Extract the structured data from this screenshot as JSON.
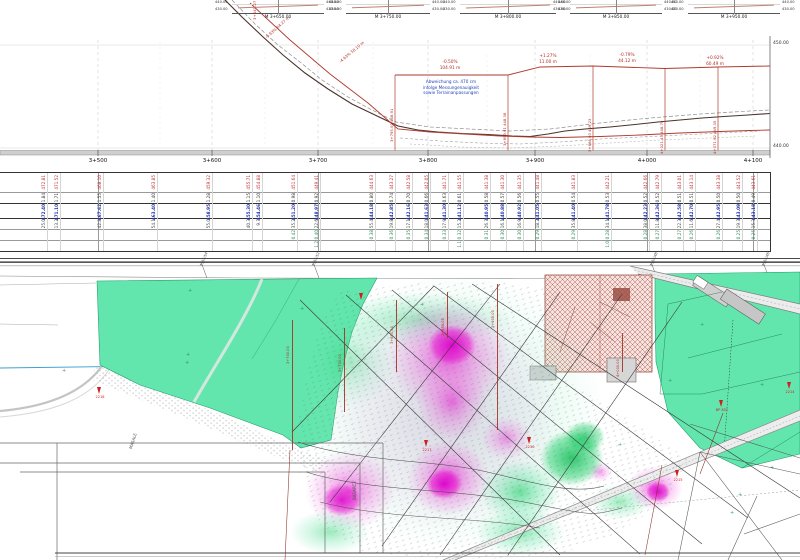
{
  "palette": {
    "mint_green": "#63e6ae",
    "heat_green": "#00c853",
    "magenta": "#e616d0",
    "magenta_light": "#f6aeec",
    "annotation_red": "#b03028",
    "dark_red": "#8b2f23",
    "annotation_blue": "#2244bb",
    "water_blue": "#3aa0d0",
    "hatch_red": "#9b4f45",
    "grid_gray": "#d9d9d9"
  },
  "cross_sections": {
    "elev_top": "440.00",
    "elev_bot": "430.00",
    "items": [
      {
        "label": "M 3+650.00",
        "x": 232,
        "w": 92
      },
      {
        "label": "M 3+750.00",
        "x": 346,
        "w": 84
      },
      {
        "label": "M 3+800.00",
        "x": 460,
        "w": 96
      },
      {
        "label": "M 3+850.00",
        "x": 570,
        "w": 92
      },
      {
        "label": "M 3+950.00",
        "x": 688,
        "w": 92
      }
    ]
  },
  "profile": {
    "elev_labels": [
      {
        "text": "450.00",
        "x": 773,
        "y": 41
      },
      {
        "text": "440.00",
        "x": 773,
        "y": 144
      }
    ],
    "stations": [
      {
        "label": "3+400",
        "x": -14
      },
      {
        "label": "3+500",
        "x": 98
      },
      {
        "label": "3+600",
        "x": 212
      },
      {
        "label": "3+700",
        "x": 318
      },
      {
        "label": "3+800",
        "x": 428
      },
      {
        "label": "3+900",
        "x": 535
      },
      {
        "label": "4+000",
        "x": 647
      },
      {
        "label": "4+100",
        "x": 753
      }
    ],
    "slope_labels": [
      {
        "grade": "-0.50%",
        "length": "104.91 m",
        "x": 450,
        "y": 60
      },
      {
        "grade": "+1.27%",
        "length": "11.00 m",
        "x": 548,
        "y": 54
      },
      {
        "grade": "-0.79%",
        "length": "44.12 m",
        "x": 627,
        "y": 53
      },
      {
        "grade": "+0.92%",
        "length": "60.49 m",
        "x": 715,
        "y": 56
      }
    ],
    "rotated_labels": [
      {
        "text": "3+641.27  461.08",
        "x": 252,
        "y": 20,
        "rot": -90
      },
      {
        "text": "-9.93%  64.27 m",
        "x": 264,
        "y": 36,
        "rot": -42
      },
      {
        "text": "-4.63%  58.10 m",
        "x": 338,
        "y": 60,
        "rot": -40
      }
    ],
    "vertical_labels": [
      {
        "text": "3+795.00  448.91",
        "x": 395,
        "y": 94
      },
      {
        "text": "3+899.91  448.38",
        "x": 508,
        "y": 98
      },
      {
        "text": "3+966.00  449.23",
        "x": 593,
        "y": 104
      },
      {
        "text": "4+021.43  448.78",
        "x": 665,
        "y": 106
      },
      {
        "text": "4+071.92  449.35",
        "x": 718,
        "y": 106
      }
    ],
    "note_lines": [
      "Abweichung ca. 470 cm",
      "infolge Messungenauigkeit",
      "sowie Terrainanpassungen"
    ]
  },
  "table": {
    "station_ticks": [
      98,
      212,
      318,
      428,
      535,
      647,
      753
    ],
    "columns": [
      [
        47,
        "472.81",
        "1.84",
        "472.40",
        "25.0",
        "",
        ""
      ],
      [
        60,
        "471.52",
        "1.71",
        "471.10",
        "13.2",
        "",
        ""
      ],
      [
        103,
        "468.10",
        "1.55",
        "467.62",
        "42.8",
        "",
        ""
      ],
      [
        157,
        "463.85",
        "1.40",
        "463.40",
        "54.1",
        "",
        ""
      ],
      [
        212,
        "459.32",
        "1.28",
        "458.95",
        "55.0",
        "",
        ""
      ],
      [
        252,
        "455.71",
        "1.15",
        "455.30",
        "40.3",
        "",
        ""
      ],
      [
        262,
        "454.88",
        "1.10",
        "454.46",
        "9.7",
        "",
        ""
      ],
      [
        297,
        "451.64",
        "0.98",
        "451.20",
        "35.2",
        "0.42",
        ""
      ],
      [
        320,
        "449.41",
        "0.92",
        "448.97",
        "22.6",
        "0.40",
        "1.2"
      ],
      [
        375,
        "444.63",
        "0.80",
        "444.18",
        "55.4",
        "0.38",
        ""
      ],
      [
        395,
        "443.27",
        "0.74",
        "442.85",
        "19.8",
        "0.36",
        ""
      ],
      [
        412,
        "442.58",
        "0.70",
        "442.16",
        "17.1",
        "0.35",
        ""
      ],
      [
        430,
        "442.05",
        "0.66",
        "441.63",
        "18.0",
        "0.34",
        ""
      ],
      [
        448,
        "441.71",
        "0.63",
        "441.30",
        "17.9",
        "0.33",
        ""
      ],
      [
        463,
        "441.55",
        "0.61",
        "441.12",
        "15.2",
        "0.32",
        "1.1"
      ],
      [
        490,
        "441.38",
        "0.58",
        "440.95",
        "26.7",
        "0.31",
        ""
      ],
      [
        506,
        "441.30",
        "0.57",
        "440.88",
        "16.1",
        "0.30",
        ""
      ],
      [
        523,
        "441.35",
        "0.56",
        "440.92",
        "16.9",
        "0.30",
        ""
      ],
      [
        541,
        "441.48",
        "0.55",
        "441.05",
        "18.2",
        "0.29",
        ""
      ],
      [
        577,
        "441.83",
        "0.54",
        "441.40",
        "35.8",
        "0.29",
        ""
      ],
      [
        611,
        "442.21",
        "0.53",
        "441.78",
        "34.1",
        "0.28",
        "1.0"
      ],
      [
        649,
        "442.66",
        "0.52",
        "442.23",
        "38.0",
        "0.28",
        ""
      ],
      [
        661,
        "442.79",
        "0.52",
        "442.36",
        "11.8",
        "0.27",
        ""
      ],
      [
        683,
        "443.01",
        "0.51",
        "442.58",
        "22.3",
        "0.27",
        ""
      ],
      [
        695,
        "443.14",
        "0.51",
        "442.70",
        "11.6",
        "0.26",
        ""
      ],
      [
        722,
        "443.38",
        "0.50",
        "442.95",
        "27.4",
        "0.26",
        ""
      ],
      [
        742,
        "443.52",
        "0.50",
        "443.09",
        "19.7",
        "0.25",
        ""
      ],
      [
        757,
        "443.61",
        "0.49",
        "443.18",
        "15.3",
        "0.25",
        ""
      ]
    ]
  },
  "plan": {
    "cadastral_labels": [
      {
        "text": "7365/54",
        "x": 203
      },
      {
        "text": "7365/52",
        "x": 315
      },
      {
        "text": "7365/48",
        "x": 653
      },
      {
        "text": "7365/46",
        "x": 765
      }
    ],
    "section_lines": [
      {
        "label": "3+700.00",
        "x": 292,
        "y1": 320,
        "y2": 450
      },
      {
        "label": "3+750.00",
        "x": 344,
        "y1": 328,
        "y2": 412
      },
      {
        "label": "3+800.00",
        "x": 396,
        "y1": 300,
        "y2": 372
      },
      {
        "label": "3+850.00",
        "x": 447,
        "y1": 292,
        "y2": 338
      },
      {
        "label": "3+900.00",
        "x": 497,
        "y1": 284,
        "y2": 430
      },
      {
        "label": "4+000.00",
        "x": 622,
        "y1": 333,
        "y2": 372
      }
    ],
    "markers": [
      {
        "label": "2218",
        "x": 100,
        "y": 387
      },
      {
        "label": "2217",
        "x": 427,
        "y": 440
      },
      {
        "label": "2216",
        "x": 530,
        "y": 437
      },
      {
        "label": "2215",
        "x": 678,
        "y": 470
      },
      {
        "label": "BP 851",
        "x": 722,
        "y": 400
      },
      {
        "label": "2214",
        "x": 790,
        "y": 382
      },
      {
        "label": "",
        "x": 362,
        "y": 293
      }
    ],
    "area_labels": [
      {
        "text": "MASALE",
        "x": 128,
        "y": 448,
        "rot": -72
      },
      {
        "text": "BASARC2",
        "x": 352,
        "y": 500,
        "rot": -90
      }
    ]
  }
}
